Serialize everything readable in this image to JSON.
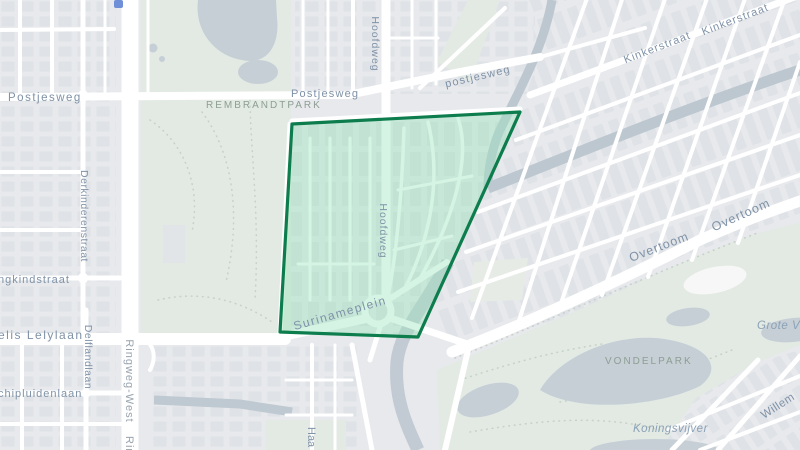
{
  "map": {
    "type": "street-map",
    "highlighted_region": {
      "name": "Surinameplein / Hoofdweg neighborhood polygon",
      "fill_color": "#9ce4bc",
      "border_color": "#0d7d4d"
    },
    "palette": {
      "base": "#e7e9ec",
      "building": "#dfe2e6",
      "road": "#ffffff",
      "park": "#e3eae3",
      "water": "#bcc7d0",
      "street_label": "#7f92a7",
      "park_label": "#8d9e93",
      "water_label": "#8ba1b6",
      "marker_blue": "#6f8fd9"
    },
    "labels": {
      "postjesweg_left": "Postjesweg",
      "postjesweg_mid": "Postjesweg",
      "postjesweg_diag": "postjesweg",
      "hoofdweg_top": "Hoofdweg",
      "hoofdweg_mid": "Hoofdweg",
      "kinkerstraat_1": "Kinkerstraat",
      "kinkerstraat_2": "Kinkerstraat",
      "derkinderenstraat": "Derkinderenstraat",
      "jongkindstraat_clipped": "ngkindstraat",
      "lelylaan_clipped": "elis Lelylaan",
      "delflandlaan": "Delflandlaan",
      "schipluidenlaan_clipped": "chipluidenlaan",
      "ringweg_west": "Ringweg-West",
      "ringweg_west_clipped": "Rin",
      "surinameplein": "Surinameplein",
      "haarlemmer_clipped": "Haa",
      "overtoom_1": "Overtoom",
      "overtoom_2": "Overtoom",
      "willem_clipped": "Willem",
      "rembrandtpark": "REMBRANDTPARK",
      "vondelpark": "VONDELPARK",
      "koningsvijver": "Koningsvijver",
      "grote_vijver_clipped": "Grote Vij"
    }
  }
}
